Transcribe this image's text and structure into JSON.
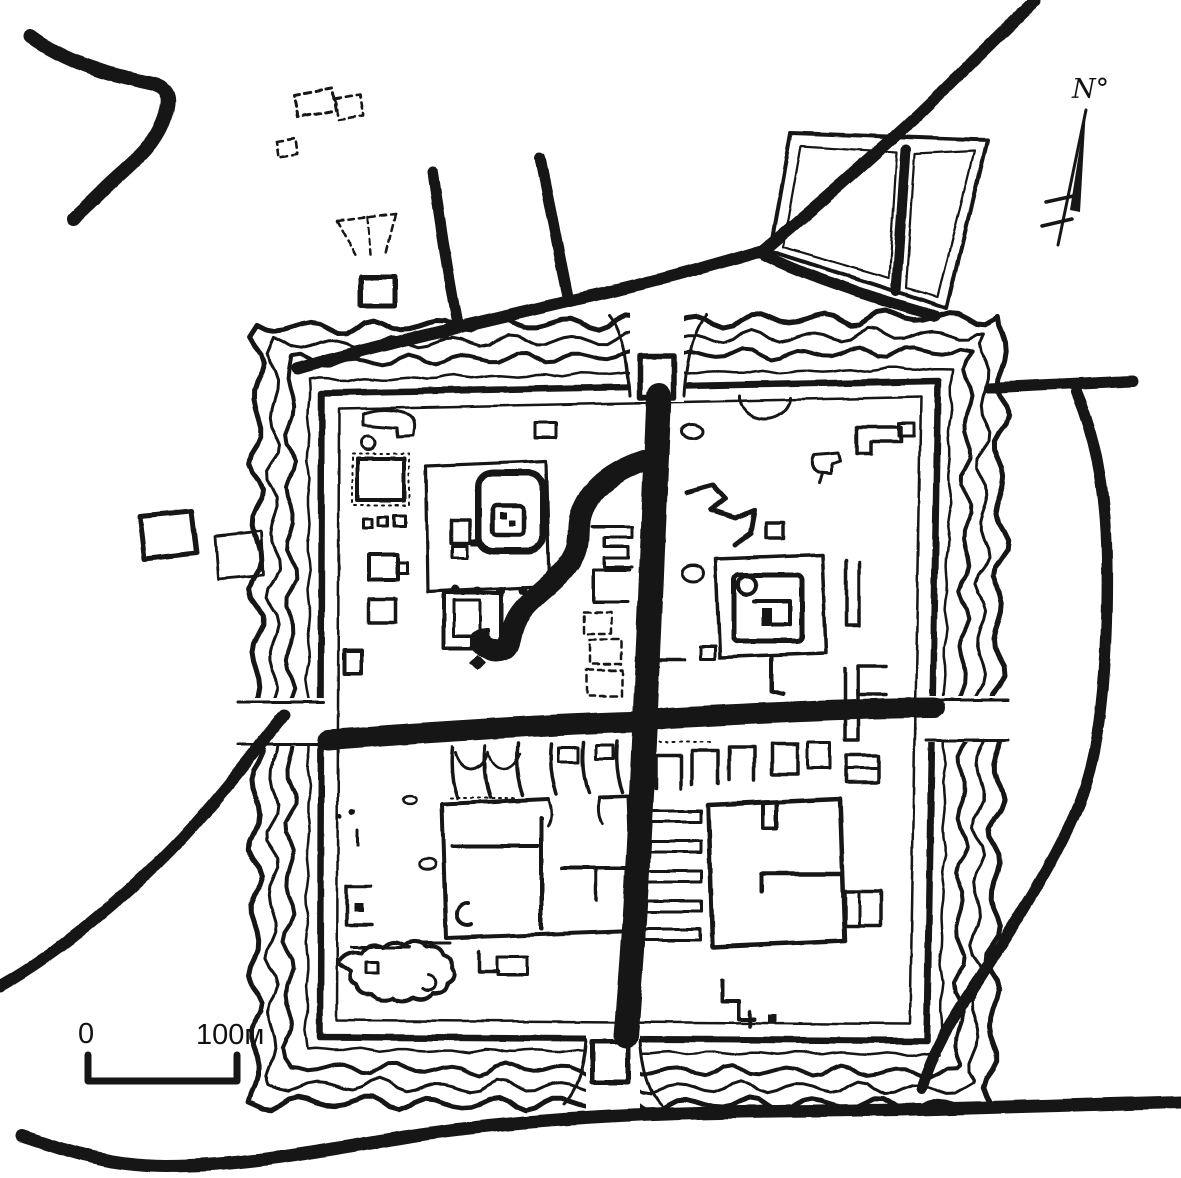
{
  "page": {
    "title": "Archaeological site plan of a square fortified town",
    "colors": {
      "ink": "#161616",
      "paper": "#ffffff"
    }
  },
  "map": {
    "type": "archaeological-site-plan",
    "compass_label": "N°",
    "scale": {
      "zero_label": "0",
      "end_label": "100м"
    },
    "moat": {
      "wavy_rings": 4,
      "gates": [
        "north",
        "west",
        "south",
        "east"
      ]
    },
    "features": [
      {
        "id": "river-northwest",
        "label": "meandering river, north-west corner"
      },
      {
        "id": "river-south",
        "label": "river along the southern edge"
      },
      {
        "id": "outlying-ruins-north",
        "label": "dashed outlying ruins north of the town"
      },
      {
        "id": "outlying-enclosures-west",
        "label": "two small enclosures west of the moat"
      },
      {
        "id": "field-enclosure-northeast",
        "label": "divided field enclosure, north-east"
      },
      {
        "id": "approach-roads",
        "label": "approach roads converging on the gates"
      },
      {
        "id": "moat-rings",
        "label": "concentric wavy moat around the rampart"
      },
      {
        "id": "rampart-wall",
        "label": "square rampart wall with four gates"
      },
      {
        "id": "main-street",
        "label": "north–south main street"
      },
      {
        "id": "cross-street",
        "label": "east–west cross street"
      },
      {
        "id": "citadel-compound-northwest",
        "label": "walled citadel compound with inner building"
      },
      {
        "id": "stream-channel",
        "label": "winding channel inside the north-west quarter"
      },
      {
        "id": "compound-northeast",
        "label": "walled compound with round corner tower"
      },
      {
        "id": "courtyard-building-southwest",
        "label": "large courtyard building"
      },
      {
        "id": "hall-building-southeast",
        "label": "large square hall with annex rooms"
      },
      {
        "id": "compass",
        "label": "north arrow"
      },
      {
        "id": "scale-bar",
        "label": "scale bar, 100 metres"
      }
    ]
  }
}
